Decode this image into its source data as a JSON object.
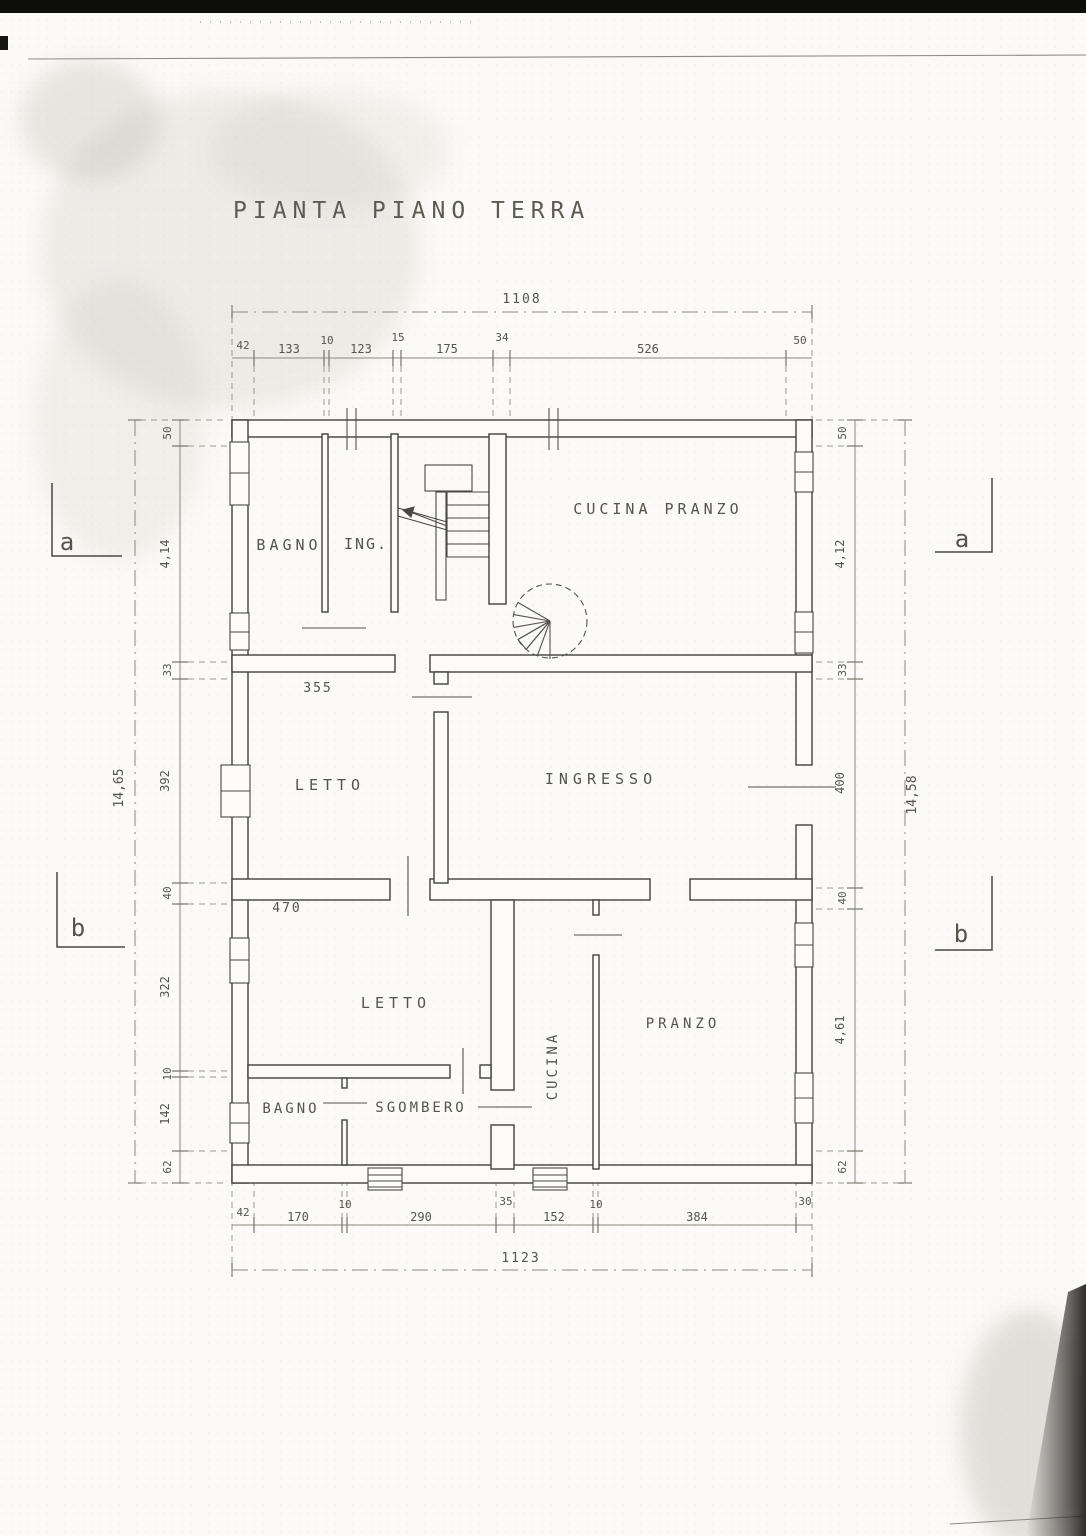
{
  "title": "PIANTA PIANO TERRA",
  "floor_plan": {
    "rooms": [
      "BAGNO",
      "ING.",
      "CUCINA  PRANZO",
      "LETTO",
      "INGRESSO",
      "LETTO",
      "BAGNO",
      "SGOMBERO",
      "CUCINA",
      "PRANZO"
    ],
    "interior_dimensions": [
      "355",
      "470"
    ],
    "section_markers": [
      "a",
      "a",
      "b",
      "b"
    ],
    "dimensions": {
      "top": {
        "total": "1108",
        "segments": [
          "42",
          "133",
          "10",
          "123",
          "15",
          "175",
          "34",
          "526",
          "50"
        ]
      },
      "bottom": {
        "total": "1123",
        "segments": [
          "42",
          "170",
          "10",
          "290",
          "35",
          "152",
          "10",
          "384",
          "30"
        ]
      },
      "left": {
        "total": "14,65",
        "segments": [
          "50",
          "4,14",
          "33",
          "392",
          "40",
          "322",
          "10",
          "142",
          "62"
        ]
      },
      "right": {
        "total": "14,58",
        "segments": [
          "50",
          "4,12",
          "33",
          "400",
          "40",
          "4,61",
          "62"
        ]
      }
    },
    "features": [
      "straight-staircase",
      "spiral-staircase"
    ]
  },
  "labels": [
    {
      "name": "page-title",
      "text": "PIANTA PIANO TERRA",
      "x": 233,
      "y": 218,
      "size": 23,
      "ls": 6,
      "anchor": "start",
      "cls": "title"
    },
    {
      "name": "room-label-bagno-top",
      "text": "BAGNO",
      "x": 289,
      "y": 550,
      "size": 15,
      "ls": 4
    },
    {
      "name": "room-label-ing",
      "text": "ING.",
      "x": 366,
      "y": 549,
      "size": 15,
      "ls": 2
    },
    {
      "name": "room-label-cucina-pranzo",
      "text": "CUCINA  PRANZO",
      "x": 658,
      "y": 514,
      "size": 15,
      "ls": 4
    },
    {
      "name": "room-label-letto-mid",
      "text": "LETTO",
      "x": 330,
      "y": 790,
      "size": 15,
      "ls": 5
    },
    {
      "name": "room-label-ingresso",
      "text": "INGRESSO",
      "x": 601,
      "y": 784,
      "size": 15,
      "ls": 5
    },
    {
      "name": "room-label-letto-bottom",
      "text": "LETTO",
      "x": 396,
      "y": 1008,
      "size": 15,
      "ls": 5
    },
    {
      "name": "room-label-bagno-bottom",
      "text": "BAGNO",
      "x": 291,
      "y": 1113,
      "size": 14,
      "ls": 3
    },
    {
      "name": "room-label-sgombero",
      "text": "SGOMBERO",
      "x": 421,
      "y": 1112,
      "size": 14,
      "ls": 3
    },
    {
      "name": "room-label-cucina",
      "text": "CUCINA",
      "x": 557,
      "y": 1066,
      "size": 14,
      "ls": 3,
      "rot": -90
    },
    {
      "name": "room-label-pranzo",
      "text": "PRANZO",
      "x": 683,
      "y": 1028,
      "size": 14,
      "ls": 4
    },
    {
      "name": "dim-letto-mid-width",
      "text": "355",
      "x": 318,
      "y": 692,
      "size": 13,
      "ls": 2
    },
    {
      "name": "dim-letto-bottom-width",
      "text": "470",
      "x": 287,
      "y": 912,
      "size": 13,
      "ls": 2
    },
    {
      "name": "dim-top-total",
      "text": "1108",
      "x": 522,
      "y": 303,
      "size": 13,
      "ls": 2
    },
    {
      "name": "dim-top-1",
      "text": "42",
      "x": 243,
      "y": 349,
      "size": 11
    },
    {
      "name": "dim-top-2",
      "text": "133",
      "x": 289,
      "y": 353,
      "size": 12
    },
    {
      "name": "dim-top-3",
      "text": "10",
      "x": 327,
      "y": 344,
      "size": 11
    },
    {
      "name": "dim-top-4",
      "text": "123",
      "x": 361,
      "y": 353,
      "size": 12
    },
    {
      "name": "dim-top-5",
      "text": "15",
      "x": 398,
      "y": 341,
      "size": 11
    },
    {
      "name": "dim-top-6",
      "text": "175",
      "x": 447,
      "y": 353,
      "size": 12
    },
    {
      "name": "dim-top-7",
      "text": "34",
      "x": 502,
      "y": 341,
      "size": 11
    },
    {
      "name": "dim-top-8",
      "text": "526",
      "x": 648,
      "y": 353,
      "size": 12
    },
    {
      "name": "dim-top-9",
      "text": "50",
      "x": 800,
      "y": 344,
      "size": 11
    },
    {
      "name": "dim-bottom-1",
      "text": "42",
      "x": 243,
      "y": 1216,
      "size": 11
    },
    {
      "name": "dim-bottom-2",
      "text": "170",
      "x": 298,
      "y": 1221,
      "size": 12
    },
    {
      "name": "dim-bottom-3",
      "text": "10",
      "x": 345,
      "y": 1208,
      "size": 11
    },
    {
      "name": "dim-bottom-4",
      "text": "290",
      "x": 421,
      "y": 1221,
      "size": 12
    },
    {
      "name": "dim-bottom-5",
      "text": "35",
      "x": 506,
      "y": 1205,
      "size": 11
    },
    {
      "name": "dim-bottom-6",
      "text": "152",
      "x": 554,
      "y": 1221,
      "size": 12
    },
    {
      "name": "dim-bottom-7",
      "text": "10",
      "x": 596,
      "y": 1208,
      "size": 11
    },
    {
      "name": "dim-bottom-8",
      "text": "384",
      "x": 697,
      "y": 1221,
      "size": 12
    },
    {
      "name": "dim-bottom-9",
      "text": "30",
      "x": 805,
      "y": 1205,
      "size": 11
    },
    {
      "name": "dim-bottom-total",
      "text": "1123",
      "x": 521,
      "y": 1262,
      "size": 13,
      "ls": 2
    },
    {
      "name": "dim-left-1",
      "text": "50",
      "x": 171,
      "y": 433,
      "size": 11,
      "rot": -90
    },
    {
      "name": "dim-left-2",
      "text": "4,14",
      "x": 169,
      "y": 554,
      "size": 12,
      "rot": -90
    },
    {
      "name": "dim-left-3",
      "text": "33",
      "x": 171,
      "y": 670,
      "size": 11,
      "rot": -90
    },
    {
      "name": "dim-left-4",
      "text": "392",
      "x": 169,
      "y": 781,
      "size": 12,
      "rot": -90
    },
    {
      "name": "dim-left-5",
      "text": "40",
      "x": 171,
      "y": 893,
      "size": 11,
      "rot": -90
    },
    {
      "name": "dim-left-6",
      "text": "322",
      "x": 169,
      "y": 987,
      "size": 12,
      "rot": -90
    },
    {
      "name": "dim-left-7",
      "text": "10",
      "x": 171,
      "y": 1074,
      "size": 11,
      "rot": -90
    },
    {
      "name": "dim-left-8",
      "text": "142",
      "x": 169,
      "y": 1114,
      "size": 12,
      "rot": -90
    },
    {
      "name": "dim-left-9",
      "text": "62",
      "x": 171,
      "y": 1167,
      "size": 11,
      "rot": -90
    },
    {
      "name": "dim-left-total",
      "text": "14,65",
      "x": 123,
      "y": 788,
      "size": 13,
      "rot": -90
    },
    {
      "name": "dim-right-1",
      "text": "50",
      "x": 846,
      "y": 433,
      "size": 11,
      "rot": -90
    },
    {
      "name": "dim-right-2",
      "text": "4,12",
      "x": 844,
      "y": 554,
      "size": 12,
      "rot": -90
    },
    {
      "name": "dim-right-3",
      "text": "33",
      "x": 846,
      "y": 670,
      "size": 11,
      "rot": -90
    },
    {
      "name": "dim-right-4",
      "text": "400",
      "x": 844,
      "y": 783,
      "size": 12,
      "rot": -90
    },
    {
      "name": "dim-right-5",
      "text": "40",
      "x": 846,
      "y": 898,
      "size": 11,
      "rot": -90
    },
    {
      "name": "dim-right-6",
      "text": "4,61",
      "x": 844,
      "y": 1030,
      "size": 12,
      "rot": -90
    },
    {
      "name": "dim-right-7",
      "text": "62",
      "x": 846,
      "y": 1167,
      "size": 11,
      "rot": -90
    },
    {
      "name": "dim-right-total",
      "text": "14,58",
      "x": 916,
      "y": 795,
      "size": 13,
      "rot": -90
    },
    {
      "name": "section-marker-a-left",
      "text": "a",
      "x": 67,
      "y": 550,
      "size": 24
    },
    {
      "name": "section-marker-a-right",
      "text": "a",
      "x": 962,
      "y": 547,
      "size": 24
    },
    {
      "name": "section-marker-b-left",
      "text": "b",
      "x": 78,
      "y": 936,
      "size": 24
    },
    {
      "name": "section-marker-b-right",
      "text": "b",
      "x": 961,
      "y": 942,
      "size": 24
    }
  ]
}
